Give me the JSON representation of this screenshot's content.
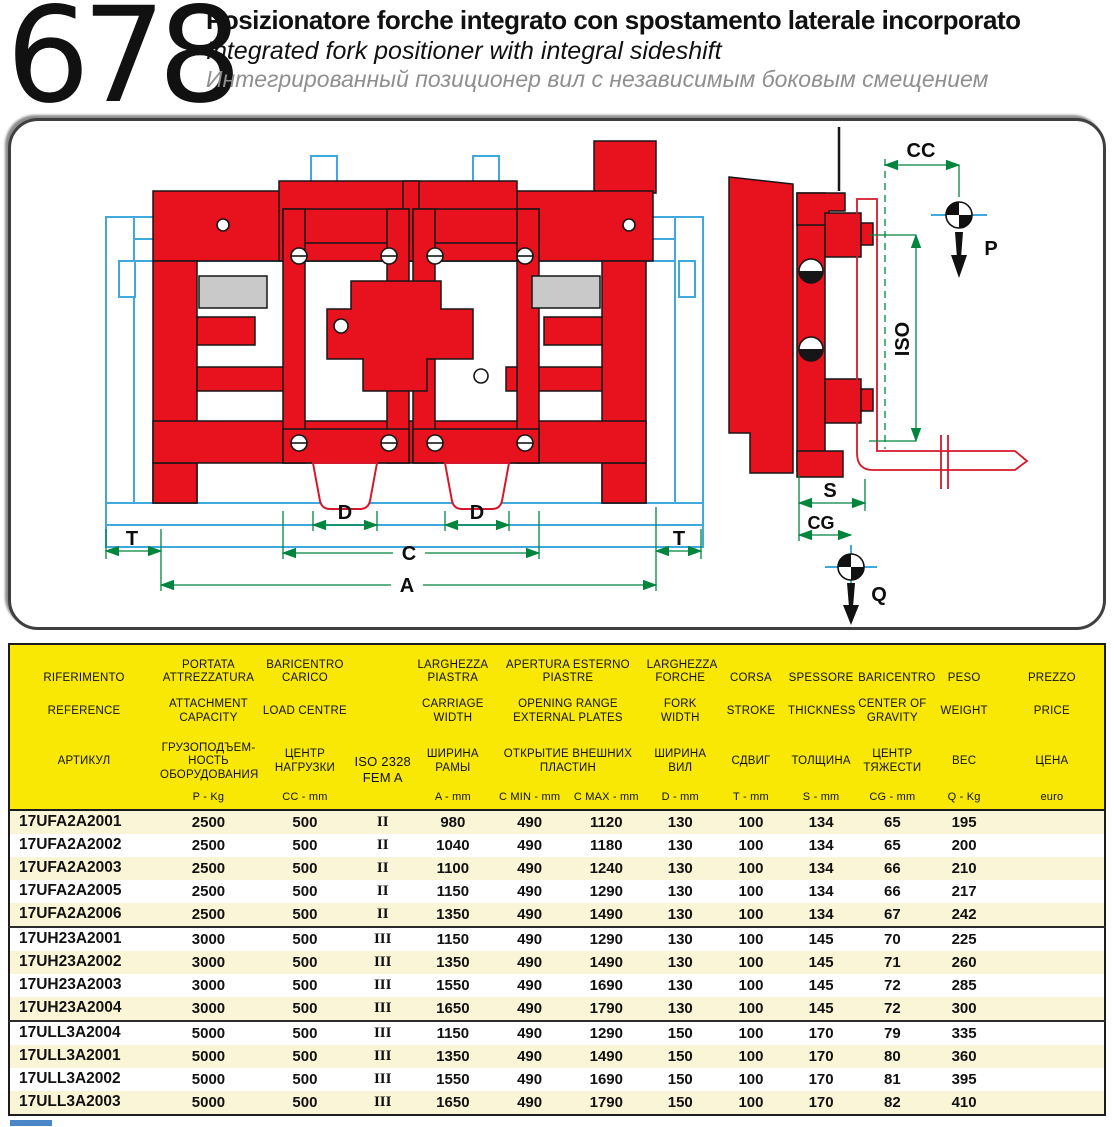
{
  "header": {
    "page_number": "678",
    "title_it": "Posizionatore forche integrato con spostamento laterale incorporato",
    "title_en": "Integrated fork positioner with integral sideshift",
    "title_ru": "Интегрированный позиционер вил с независимым боковым смещением"
  },
  "drawing": {
    "front": {
      "t_left": "T",
      "d_left": "D",
      "d_right": "D",
      "c": "C",
      "a": "A",
      "t_right": "T"
    },
    "side": {
      "cc": "CC",
      "p": "P",
      "iso": "ISO",
      "s": "S",
      "cg": "CG",
      "q": "Q"
    }
  },
  "colors": {
    "body_red": "#E8111E",
    "carriage_blue": "#3FA8DC",
    "dimension_green": "#00853E",
    "header_yellow": "#F8E804",
    "row_cream": "#FBF5D8",
    "slot_gray": "#C9C9C9",
    "footer_blue": "#4a86c8"
  },
  "table": {
    "columns": {
      "ref": {
        "it": "RIFERIMENTO",
        "en": "REFERENCE",
        "ru": "АРТИКУЛ",
        "unit": ""
      },
      "capacity": {
        "it": "PORTATA ATTREZZATURA",
        "en": "ATTACHMENT CAPACITY",
        "ru": "ГРУЗОПОДЪЕМ-НОСТЬ ОБОРУДОВАНИЯ",
        "unit": "P - Kg"
      },
      "load_centre": {
        "it": "BARICENTRO CARICO",
        "en": "LOAD CENTRE",
        "ru": "ЦЕНТР НАГРУЗКИ",
        "unit": "CC - mm"
      },
      "iso": {
        "line1": "ISO 2328",
        "line2": "FEM A",
        "unit": ""
      },
      "carriage_width": {
        "it": "LARGHEZZA PIASTRA",
        "en": "CARRIAGE WIDTH",
        "ru": "ШИРИНА РАМЫ",
        "unit": "A - mm"
      },
      "opening": {
        "it": "APERTURA ESTERNO PIASTRE",
        "en": "OPENING RANGE EXTERNAL PLATES",
        "ru": "ОТКРЫТИЕ ВНЕШНИХ ПЛАСТИН",
        "unit_min": "C MIN - mm",
        "unit_max": "C MAX - mm"
      },
      "fork_width": {
        "it": "LARGHEZZA FORCHE",
        "en": "FORK WIDTH",
        "ru": "ШИРИНА ВИЛ",
        "unit": "D - mm"
      },
      "stroke": {
        "it": "CORSA",
        "en": "STROKE",
        "ru": "СДВИГ",
        "unit": "T - mm"
      },
      "thickness": {
        "it": "SPESSORE",
        "en": "THICKNESS",
        "ru": "ТОЛЩИНА",
        "unit": "S -  mm"
      },
      "cog": {
        "it": "BARICENTRO",
        "en": "CENTER OF GRAVITY",
        "ru": "ЦЕНТР ТЯЖЕСТИ",
        "unit": "CG - mm"
      },
      "weight": {
        "it": "PESO",
        "en": "WEIGHT",
        "ru": "ВЕС",
        "unit": "Q - Kg"
      },
      "price": {
        "it": "PREZZO",
        "en": "PRICE",
        "ru": "ЦЕНА",
        "unit": "euro"
      }
    },
    "rows": [
      [
        "17UFA2A2001",
        "2500",
        "500",
        "II",
        "980",
        "490",
        "1120",
        "130",
        "100",
        "134",
        "65",
        "195",
        ""
      ],
      [
        "17UFA2A2002",
        "2500",
        "500",
        "II",
        "1040",
        "490",
        "1180",
        "130",
        "100",
        "134",
        "65",
        "200",
        ""
      ],
      [
        "17UFA2A2003",
        "2500",
        "500",
        "II",
        "1100",
        "490",
        "1240",
        "130",
        "100",
        "134",
        "66",
        "210",
        ""
      ],
      [
        "17UFA2A2005",
        "2500",
        "500",
        "II",
        "1150",
        "490",
        "1290",
        "130",
        "100",
        "134",
        "66",
        "217",
        ""
      ],
      [
        "17UFA2A2006",
        "2500",
        "500",
        "II",
        "1350",
        "490",
        "1490",
        "130",
        "100",
        "134",
        "67",
        "242",
        ""
      ],
      [
        "17UH23A2001",
        "3000",
        "500",
        "III",
        "1150",
        "490",
        "1290",
        "130",
        "100",
        "145",
        "70",
        "225",
        ""
      ],
      [
        "17UH23A2002",
        "3000",
        "500",
        "III",
        "1350",
        "490",
        "1490",
        "130",
        "100",
        "145",
        "71",
        "260",
        ""
      ],
      [
        "17UH23A2003",
        "3000",
        "500",
        "III",
        "1550",
        "490",
        "1690",
        "130",
        "100",
        "145",
        "72",
        "285",
        ""
      ],
      [
        "17UH23A2004",
        "3000",
        "500",
        "III",
        "1650",
        "490",
        "1790",
        "130",
        "100",
        "145",
        "72",
        "300",
        ""
      ],
      [
        "17ULL3A2004",
        "5000",
        "500",
        "III",
        "1150",
        "490",
        "1290",
        "150",
        "100",
        "170",
        "79",
        "335",
        ""
      ],
      [
        "17ULL3A2001",
        "5000",
        "500",
        "III",
        "1350",
        "490",
        "1490",
        "150",
        "100",
        "170",
        "80",
        "360",
        ""
      ],
      [
        "17ULL3A2002",
        "5000",
        "500",
        "III",
        "1550",
        "490",
        "1690",
        "150",
        "100",
        "170",
        "81",
        "395",
        ""
      ],
      [
        "17ULL3A2003",
        "5000",
        "500",
        "III",
        "1650",
        "490",
        "1790",
        "150",
        "100",
        "170",
        "82",
        "410",
        ""
      ]
    ],
    "group_breaks_after": [
      4,
      8
    ]
  }
}
